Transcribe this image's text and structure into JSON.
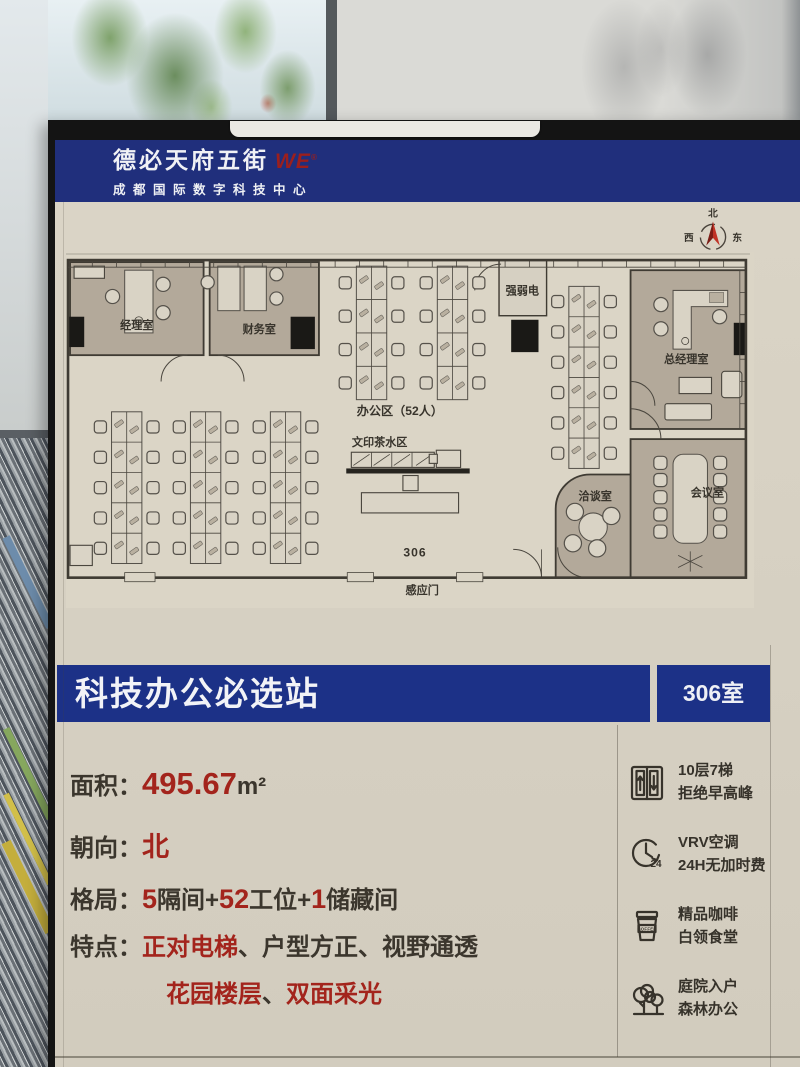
{
  "header": {
    "brand": "德必天府五街",
    "logo": "WE",
    "logo_mark": "®",
    "subtitle": "成都国际数字科技中心"
  },
  "compass": {
    "n": "北",
    "e": "东",
    "s": "南",
    "w": "西"
  },
  "floor_plan": {
    "labels": {
      "manager_room": "经理室",
      "finance_room": "财务室",
      "utility_room": "强弱电",
      "gm_room": "总经理室",
      "meeting_room": "会议室",
      "negotiation_room": "洽谈室",
      "office_area": "办公区（52人）",
      "print_tea_area": "文印茶水区",
      "room_number": "306",
      "sensor_door": "感应门"
    }
  },
  "banner": {
    "title": "科技办公必选站",
    "room": "306室"
  },
  "details": {
    "area": {
      "label": "面积：",
      "value": "495.67",
      "unit": "m²"
    },
    "orientation": {
      "label": "朝向：",
      "value": "北"
    },
    "layout": {
      "label": "格局：",
      "n1": "5",
      "t1": "隔间+",
      "n2": "52",
      "t2": "工位+",
      "n3": "1",
      "t3": "储藏间"
    },
    "features": {
      "label": "特点：",
      "hl1": "正对电梯",
      "sep1": "、",
      "f2": "户型方正",
      "sep2": "、",
      "f3": "视野通透"
    },
    "features2": {
      "hl1": "花园楼层",
      "sep": "、",
      "hl2": "双面采光"
    }
  },
  "amenities": [
    {
      "icon": "elevator-icon",
      "line1": "10层7梯",
      "line2": "拒绝早高峰"
    },
    {
      "icon": "clock-24h-icon",
      "line1": "VRV空调",
      "line2": "24H无加时费"
    },
    {
      "icon": "coffee-icon",
      "line1": "精品咖啡",
      "line2": "白领食堂"
    },
    {
      "icon": "trees-icon",
      "line1": "庭院入户",
      "line2": "森林办公"
    }
  ],
  "icon_texts": {
    "coffee": "COFFEE",
    "clock": "24"
  },
  "colors": {
    "blue": "#1c3187",
    "red": "#a3241c",
    "paper": "#d8d2c4",
    "ink": "#3b362d"
  }
}
